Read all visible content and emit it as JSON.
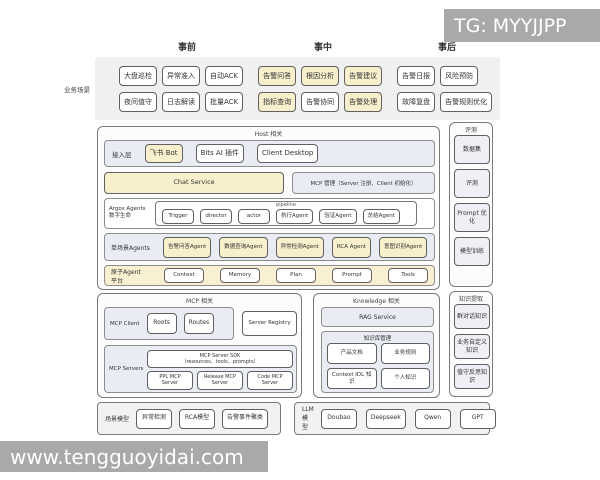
{
  "watermark_top": "TG: MYYJJPP",
  "watermark_bottom": "www.tengguoyidai.com",
  "phases": {
    "pre": "事前",
    "mid": "事中",
    "post": "事后"
  },
  "scenario": {
    "label": "业务场景",
    "row1": [
      {
        "label": "大盘巡检"
      },
      {
        "label": "异常准入"
      },
      {
        "label": "自动ACK"
      },
      {
        "label": "告警问答",
        "hl": true
      },
      {
        "label": "根因分析",
        "hl": true
      },
      {
        "label": "告警建议",
        "hl": true
      },
      {
        "label": "告警日报"
      },
      {
        "label": "风险预防"
      }
    ],
    "row2": [
      {
        "label": "夜间值守"
      },
      {
        "label": "日志解读"
      },
      {
        "label": "批量ACK"
      },
      {
        "label": "指标查询",
        "hl": true
      },
      {
        "label": "告警协同"
      },
      {
        "label": "告警处理",
        "hl": true
      },
      {
        "label": "故障复盘"
      },
      {
        "label": "告警规则优化"
      }
    ]
  },
  "host": {
    "title": "Host 相关",
    "access": {
      "label": "接入层",
      "items": [
        {
          "label": "飞书 Bot",
          "hl": true
        },
        {
          "label": "Bits AI 插件"
        },
        {
          "label": "Client Desktop"
        }
      ]
    },
    "chat_service": "Chat Service",
    "mcp_mgmt": "MCP 管理（Server 注册、Client 初始化）",
    "argos": {
      "label_line1": "Argos Agents",
      "label_line2": "数字生命",
      "pipeline_title": "pipeline",
      "pipeline": [
        {
          "label": "Trigger"
        },
        {
          "label": "director"
        },
        {
          "label": "actor"
        },
        {
          "label": "执行Agent"
        },
        {
          "label": "验证Agent"
        },
        {
          "label": "总结Agent"
        }
      ]
    },
    "single_agents": {
      "label": "单场景Agents",
      "items": [
        {
          "label": "告警问答Agent",
          "hl": true
        },
        {
          "label": "数据查询Agent",
          "hl": true
        },
        {
          "label": "异常检测Agent",
          "hl": true
        },
        {
          "label": "RCA Agent",
          "hl": true
        },
        {
          "label": "意图识别Agent",
          "hl": true
        }
      ]
    },
    "atomic": {
      "label": "原子Agent 平台",
      "items": [
        {
          "label": "Context"
        },
        {
          "label": "Memory"
        },
        {
          "label": "Plan"
        },
        {
          "label": "Prompt"
        },
        {
          "label": "Tools"
        }
      ]
    }
  },
  "mcp": {
    "title": "MCP 相关",
    "client": {
      "label": "MCP Client",
      "items": [
        {
          "label": "Roots"
        },
        {
          "label": "Routes"
        }
      ]
    },
    "server_registry": "Server Registry",
    "servers": {
      "label": "MCP Servers",
      "sdk_line1": "MCP Server SDK",
      "sdk_line2": "（resources、tools、prompts）",
      "items": [
        {
          "label": "PPL MCP Server"
        },
        {
          "label": "Release MCP Server"
        },
        {
          "label": "Code MCP Server"
        }
      ]
    }
  },
  "knowledge": {
    "title": "Knowledge 相关",
    "rag": "RAG Service",
    "kb": {
      "title": "知识库管理",
      "items": [
        {
          "label": "产品文档"
        },
        {
          "label": "业务规则"
        },
        {
          "label": "Context IDL 知识"
        },
        {
          "label": "个人知识"
        }
      ]
    }
  },
  "eval_panel": {
    "title": "评测",
    "items": [
      {
        "label": "数据集"
      },
      {
        "label": "评测"
      },
      {
        "label": "Prompt 优化"
      },
      {
        "label": "模型训练"
      }
    ]
  },
  "extract_panel": {
    "title": "知识提取",
    "items": [
      {
        "label": "群对话知识"
      },
      {
        "label": "业务自定义知识"
      },
      {
        "label": "值守反思知识"
      }
    ]
  },
  "scene_models": {
    "label": "场景模型",
    "items": [
      {
        "label": "异常检测"
      },
      {
        "label": "RCA模型"
      },
      {
        "label": "告警事件聚类"
      }
    ]
  },
  "llm_models": {
    "label": "LLM模型",
    "items": [
      {
        "label": "Doubao"
      },
      {
        "label": "Deepseek"
      },
      {
        "label": "Qwen"
      },
      {
        "label": "GPT"
      }
    ]
  },
  "colors": {
    "highlight": "#f8efcd",
    "container": "#eaecf4",
    "band": "#f0f0f0",
    "watermark": "#a9a9a9"
  }
}
